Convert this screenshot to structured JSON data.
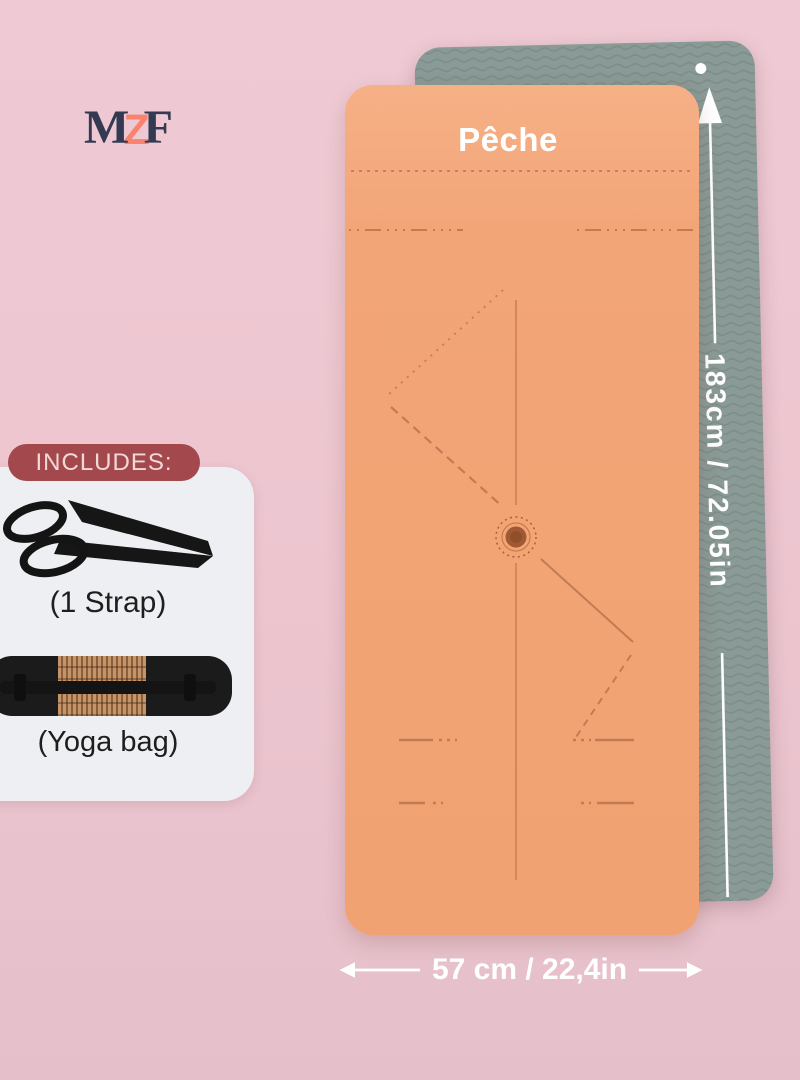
{
  "colors": {
    "bg-top": "#efcad4",
    "bg-bottom": "#e5c0ca",
    "mat-front": "#f2a577",
    "mat-front-light": "#f6b086",
    "mat-back": "#8a9a96",
    "mat-back-wave": "#75857f",
    "marking": "#bb7750",
    "badge": "#a3494e",
    "badge-text": "#f2d8d6",
    "panel": "#edeff2",
    "logo-navy": "#333a52",
    "logo-coral": "#f9836d",
    "white": "#ffffff",
    "item-text": "#1e1e1e"
  },
  "logo": {
    "letter_m": "M",
    "letter_z": "Z",
    "letter_f": "F"
  },
  "product": {
    "color_label": "Pêche"
  },
  "dimensions": {
    "length_label": "183cm / 72.05in",
    "width_label": "57 cm / 22,4in"
  },
  "includes": {
    "title": "INCLUDES:",
    "items": [
      {
        "label": "(1 Strap)",
        "icon": "strap-icon"
      },
      {
        "label": "(Yoga bag)",
        "icon": "yoga-bag-icon"
      }
    ]
  }
}
